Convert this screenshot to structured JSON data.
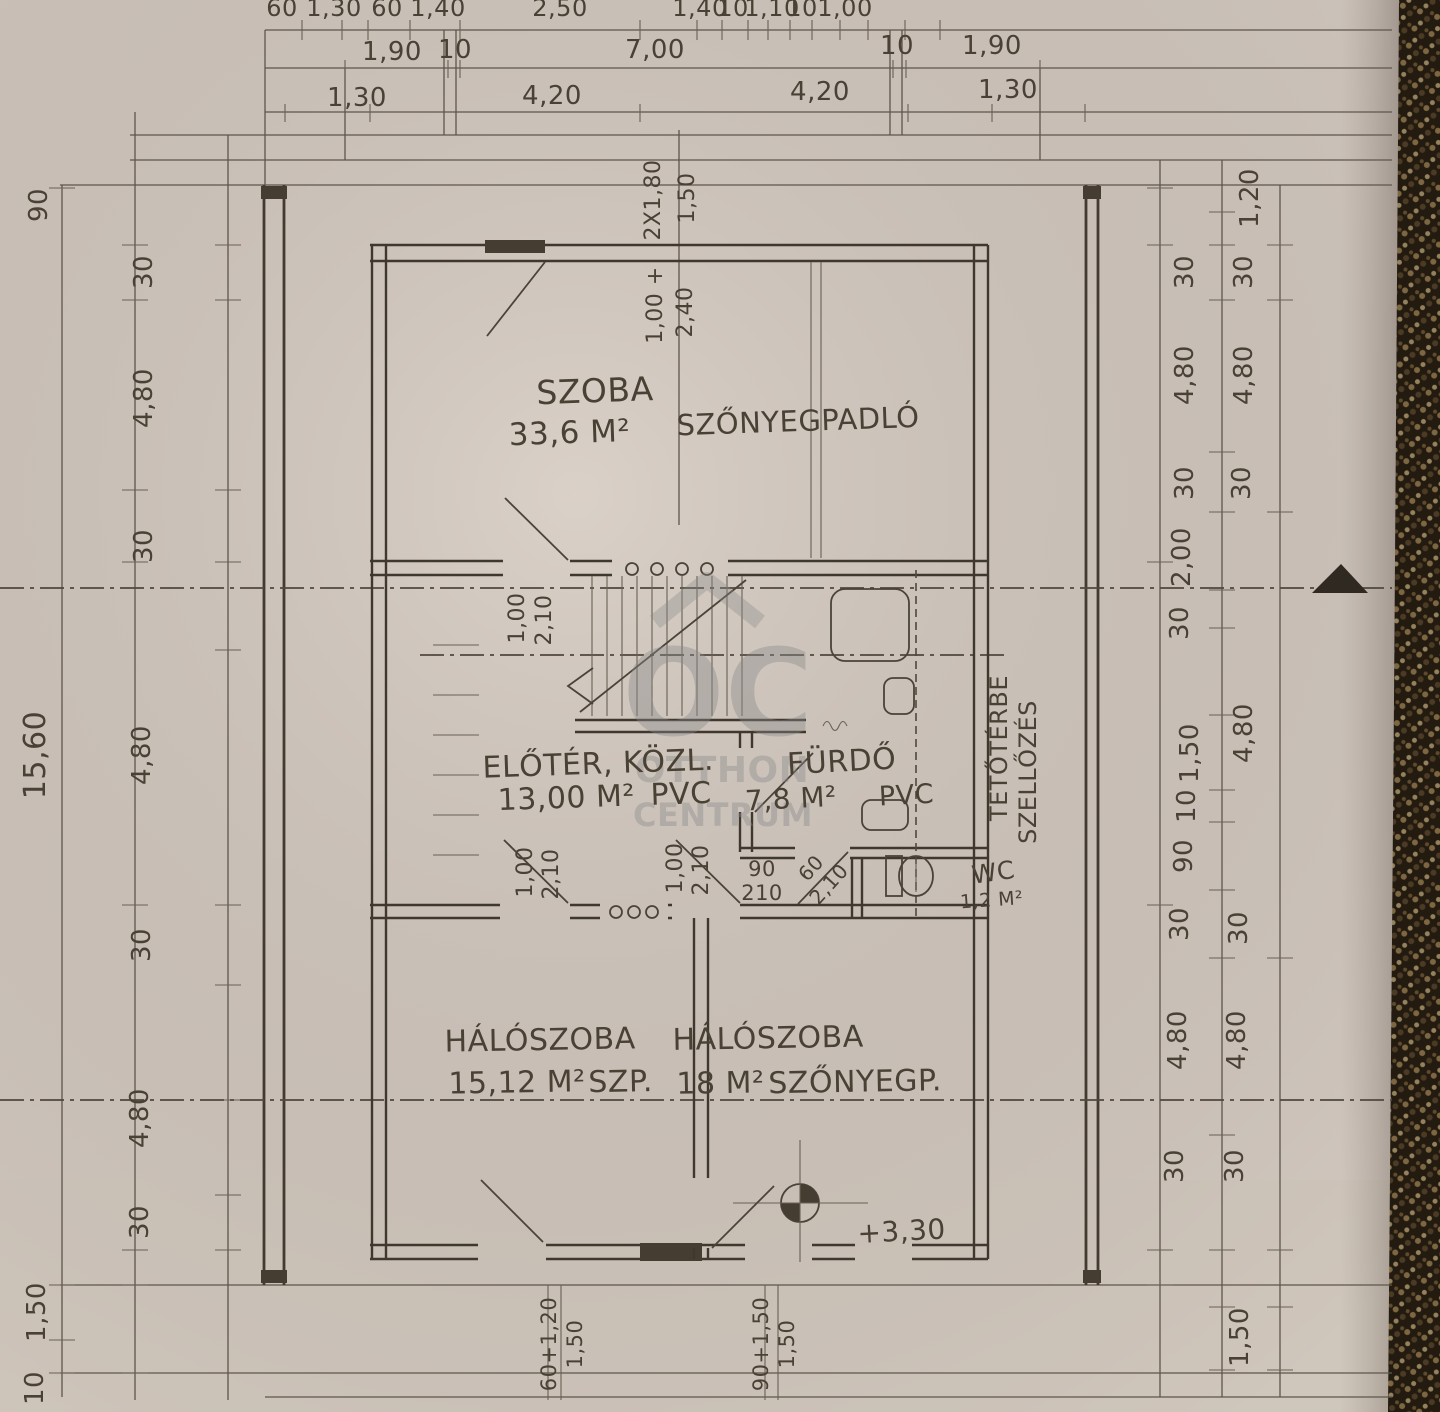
{
  "colors": {
    "paper": "#d3c9c0",
    "ink": "#4a4135",
    "wall": "#3f382e",
    "carpet": "#261c11",
    "watermark_gray": "#8a8a8a"
  },
  "watermark": {
    "monogram": "OC",
    "line1": "OTTHON",
    "line2": "CENTRUM"
  },
  "rooms": [
    {
      "name": "SZOBA",
      "area": "33,6 M²",
      "floor": "SZŐNYEGPADLÓ"
    },
    {
      "name": "ELŐTÉR, KÖZL.",
      "area": "13,00 M²",
      "floor": "PVC"
    },
    {
      "name": "FÜRDŐ",
      "area": "7,8 M²",
      "floor": "PVC"
    },
    {
      "name": "WC",
      "area": "1,2 M²"
    },
    {
      "name": "HÁLÓSZOBA",
      "area": "15,12 M²",
      "floor": "SZP."
    },
    {
      "name": "HÁLÓSZOBA",
      "area": "18 M²",
      "floor": "SZŐNYEGP."
    }
  ],
  "annotations": {
    "attic_line1": "TETŐTÉRBE",
    "attic_line2": "SZELLŐZÉS",
    "level_mark": "+3,30"
  },
  "dims": {
    "top1": [
      "60",
      "1,30",
      "60",
      "1,40",
      "2,50",
      "1,40",
      "10",
      "1,10",
      "10",
      "1,00"
    ],
    "top2": [
      "1,90",
      "10",
      "7,00",
      "10",
      "1,90"
    ],
    "top3": [
      "1,30",
      "4,20",
      "4,20",
      "1,30"
    ],
    "left_outer": [
      "90",
      "15,60",
      "1,50",
      "10"
    ],
    "left_inner": [
      "30",
      "4,80",
      "30",
      "4,80",
      "30",
      "4,80",
      "30"
    ],
    "right_inner": [
      "30",
      "4,80",
      "30",
      "2,00",
      "30",
      "1,50",
      "10",
      "90",
      "30",
      "4,80",
      "30"
    ],
    "right_outer": [
      "1,20",
      "30",
      "4,80",
      "30",
      "4,80",
      "30",
      "4,80",
      "30",
      "1,50"
    ],
    "openings": [
      {
        "w": "2X1,80",
        "h": "1,50"
      },
      {
        "w": "1,00 +",
        "h": "2,40"
      },
      {
        "w": "1,00",
        "h": "2,10"
      },
      {
        "w": "1,00",
        "h": "2,10"
      },
      {
        "w": "1,00",
        "h": "2,10"
      },
      {
        "w": "90",
        "h": "210"
      },
      {
        "w": "60",
        "h": "2,10"
      },
      {
        "w": "60+1,20",
        "h": "1,50"
      },
      {
        "w": "90+1,50",
        "h": "1,50"
      }
    ]
  }
}
